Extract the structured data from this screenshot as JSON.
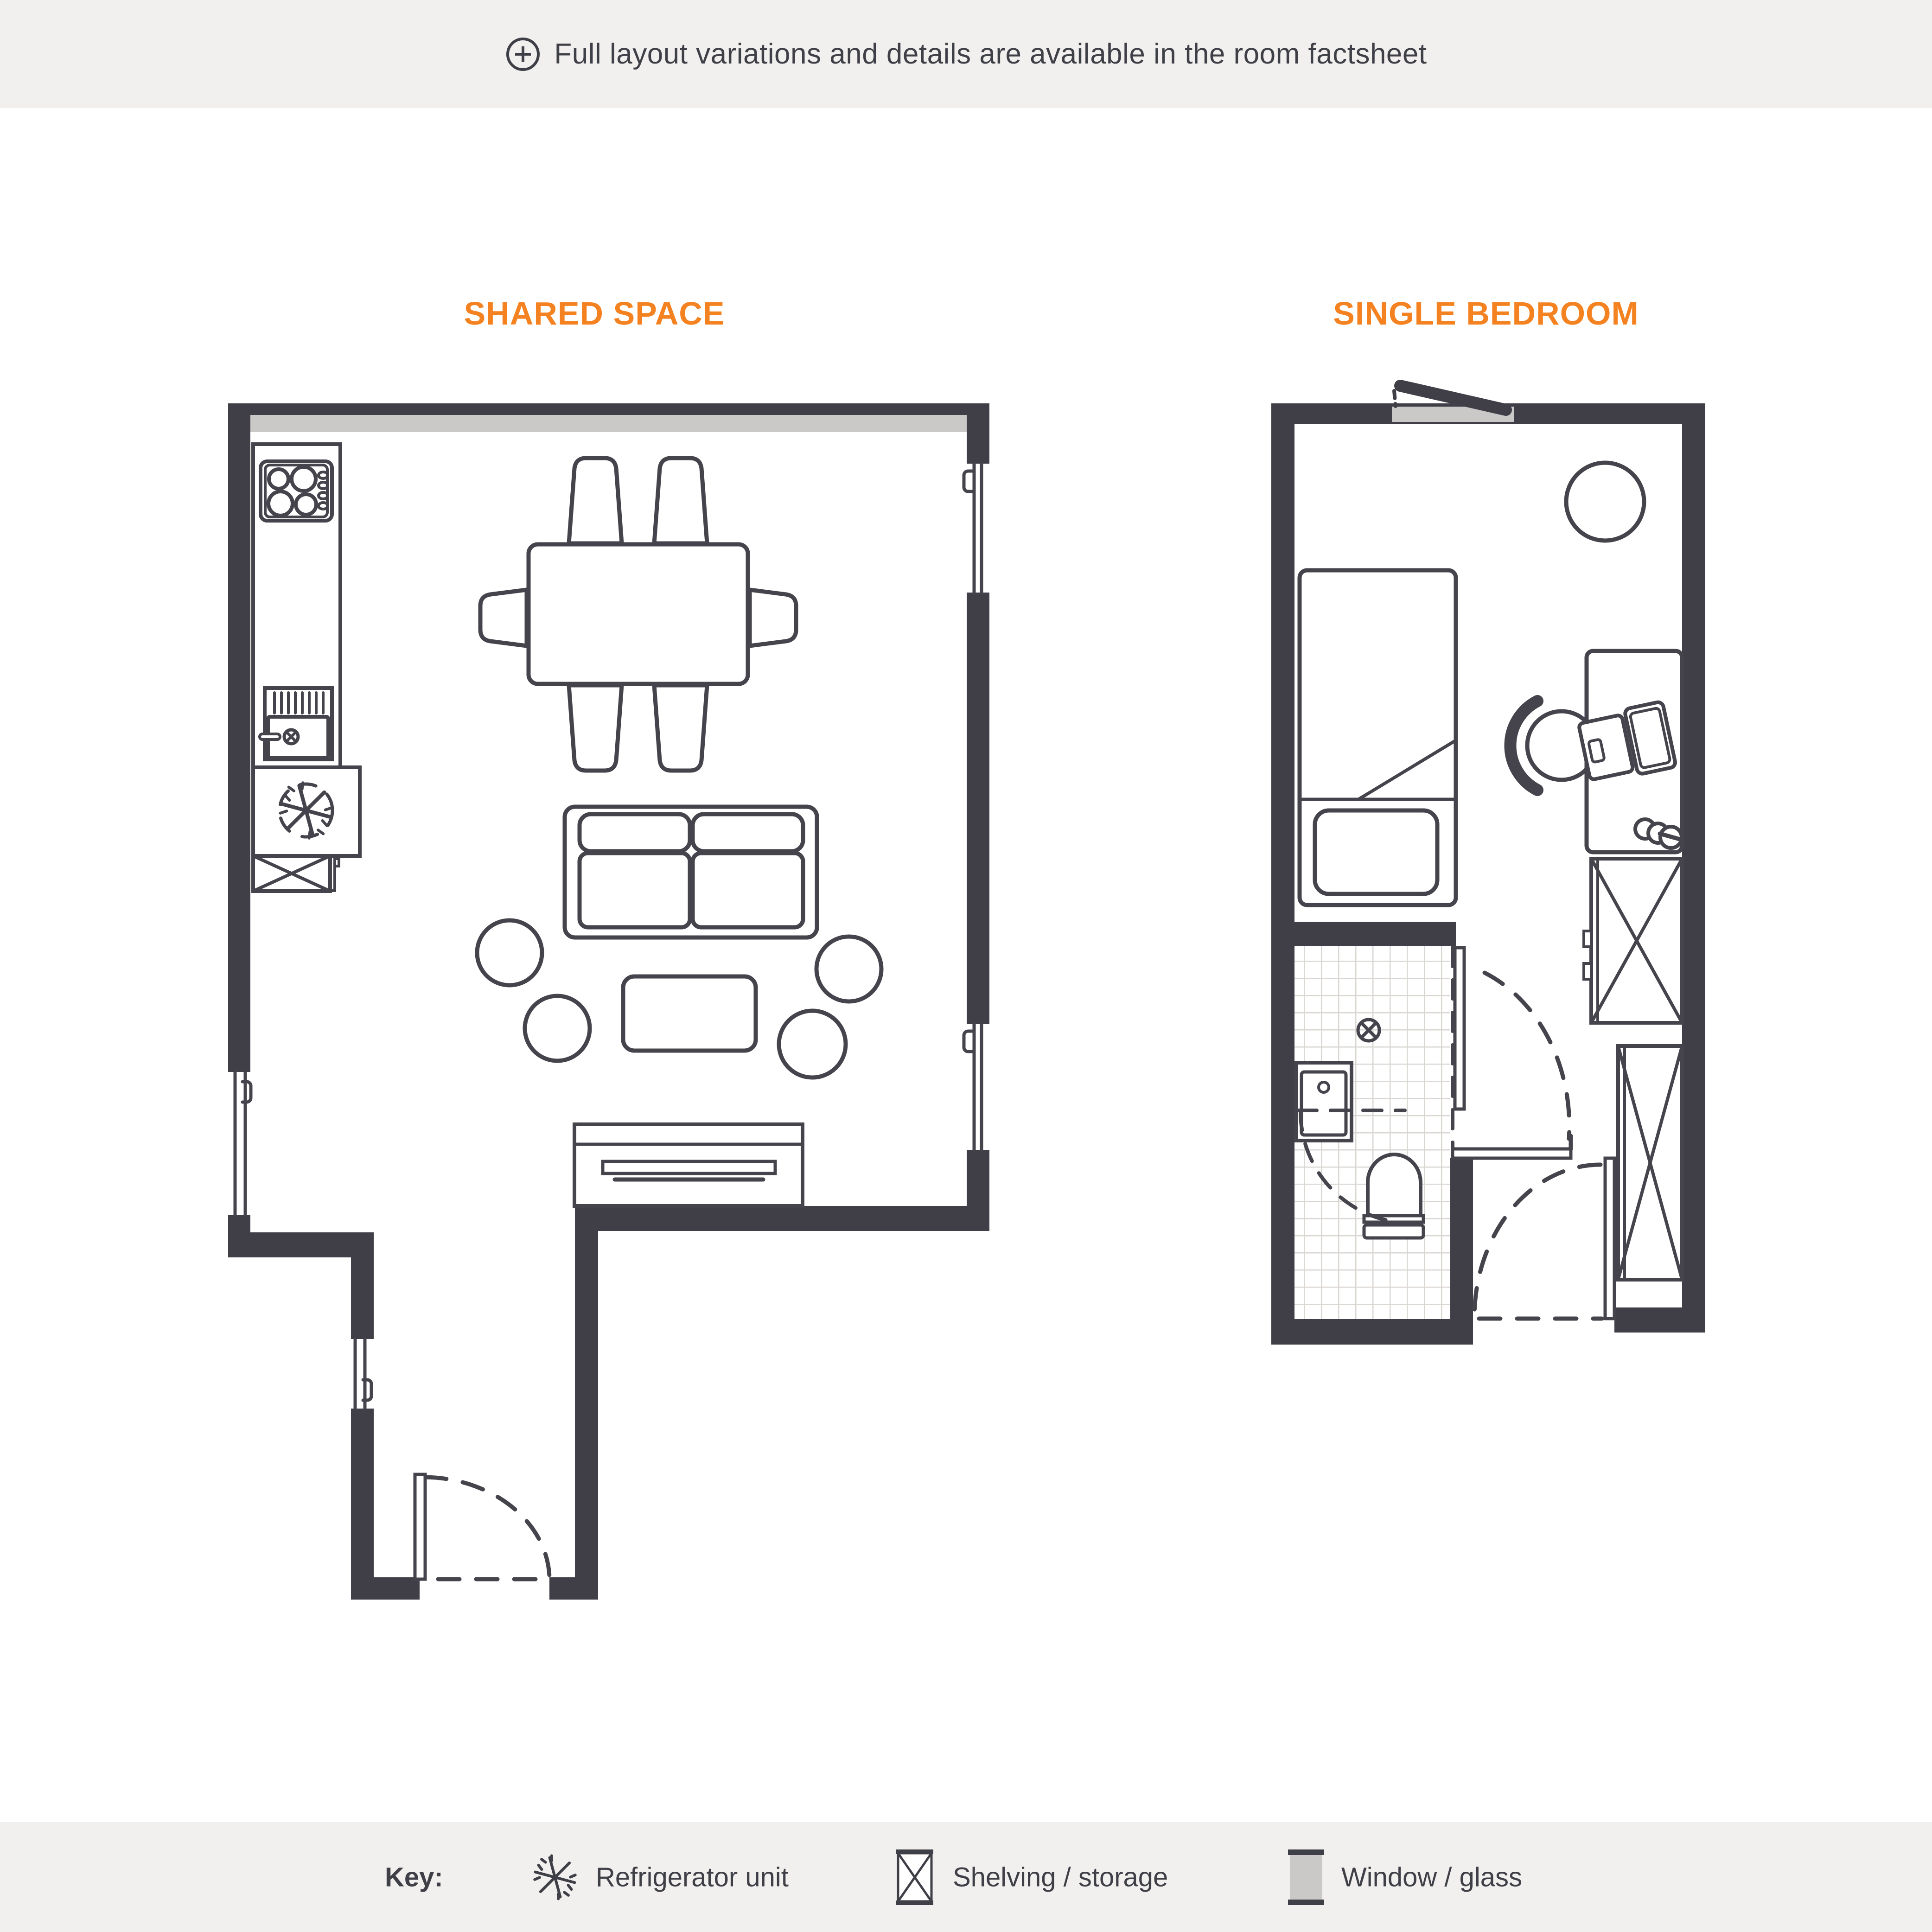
{
  "banner": {
    "icon": "plus-circle-icon",
    "text": "Full layout variations and details are available in the room factsheet"
  },
  "plans": {
    "shared_title": "SHARED SPACE",
    "bedroom_title": "SINGLE BEDROOM"
  },
  "legend": {
    "key_label": "Key:",
    "items": [
      {
        "icon": "snowflake-icon",
        "label": "Refrigerator unit"
      },
      {
        "icon": "crossed-box-icon",
        "label": "Shelving / storage"
      },
      {
        "icon": "window-glass-icon",
        "label": "Window / glass"
      }
    ]
  },
  "colors": {
    "accent": "#F58220",
    "wall": "#403F47",
    "line": "#45444C",
    "glass": "#CBC9C7",
    "strip_bg": "#F2F0EE",
    "tile_line": "#DAD7D3"
  }
}
